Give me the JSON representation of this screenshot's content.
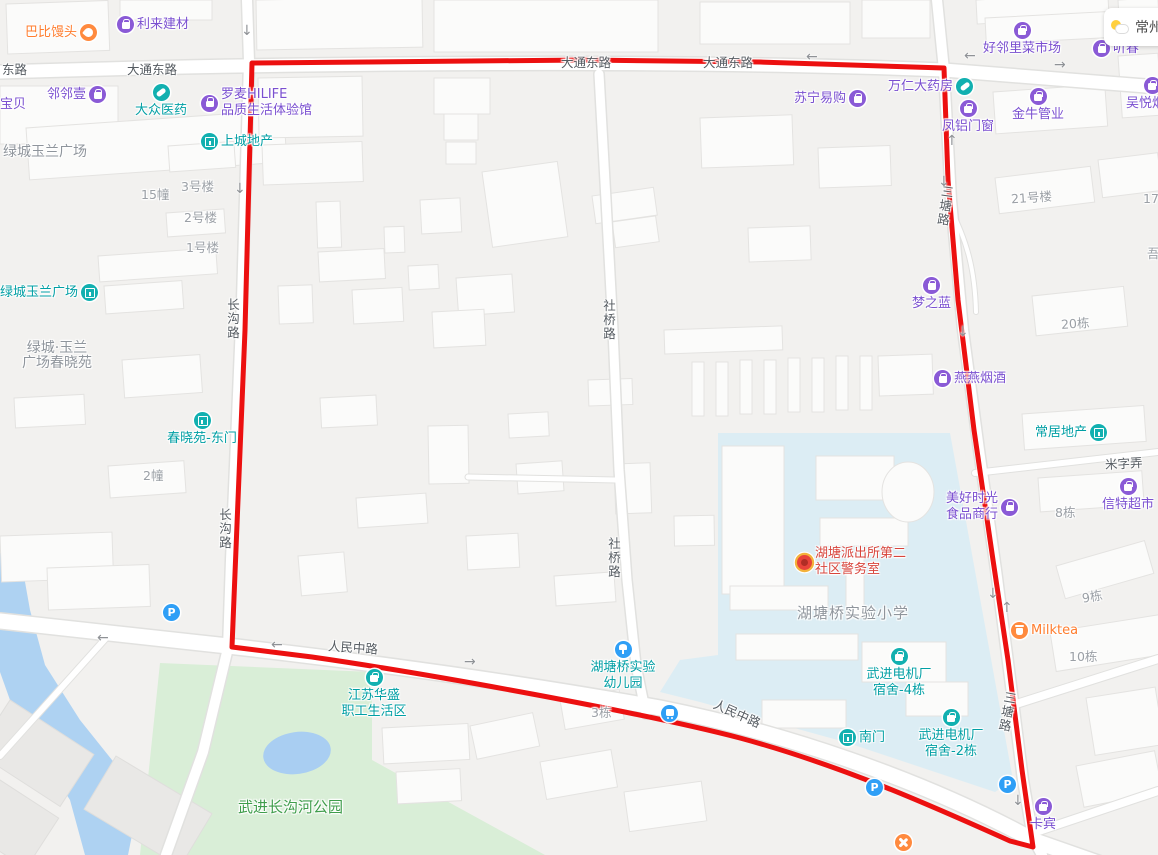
{
  "weather": {
    "city": "常州"
  },
  "colors": {
    "route_red": "#ec1010",
    "school_zone": "#dcedf4",
    "park_green": "#d9eed7",
    "water_blue": "#aed2f2",
    "poi_purple": "#7a4fd0",
    "poi_teal": "#009fa4",
    "poi_orange": "#ff7d2e",
    "poi_red": "#d8453c",
    "util_blue": "#2f9ff6"
  },
  "map": {
    "labels": [
      {
        "name": "road-donglu",
        "cls": "cls-road",
        "x": 2,
        "y": 62,
        "text": "东路"
      },
      {
        "name": "road-datongdonglu-1",
        "cls": "cls-road",
        "x": 127,
        "y": 62,
        "text": "大通东路"
      },
      {
        "name": "road-datongdonglu-2",
        "cls": "cls-road",
        "x": 561,
        "y": 55,
        "text": "大通东路"
      },
      {
        "name": "road-datongdonglu-3",
        "cls": "cls-road",
        "x": 703,
        "y": 55,
        "text": "大通东路"
      },
      {
        "name": "road-renminzhonglu-1",
        "cls": "cls-road",
        "x": 328,
        "y": 640,
        "rot": 4,
        "text": "人民中路"
      },
      {
        "name": "road-renminzhonglu-2",
        "cls": "cls-road",
        "x": 712,
        "y": 706,
        "rot": 24,
        "text": "人民中路"
      },
      {
        "name": "road-mizinong",
        "cls": "cls-road",
        "x": 1105,
        "y": 456,
        "rot": -3,
        "text": "米字弄"
      },
      {
        "name": "road-changgoulu-1",
        "cls": "cls-road",
        "x": 226,
        "y": 298,
        "vert": true,
        "text": "长沟路"
      },
      {
        "name": "road-changgoulu-2",
        "cls": "cls-road",
        "x": 218,
        "y": 508,
        "vert": true,
        "text": "长沟路"
      },
      {
        "name": "road-sheqiaolu-1",
        "cls": "cls-road",
        "x": 602,
        "y": 299,
        "vert": true,
        "text": "社桥路"
      },
      {
        "name": "road-sheqiaolu-2",
        "cls": "cls-road",
        "x": 607,
        "y": 537,
        "vert": true,
        "text": "社桥路"
      },
      {
        "name": "road-santanglu-1",
        "cls": "cls-road",
        "x": 938,
        "y": 185,
        "rot": 8,
        "vert": true,
        "text": "三塘路"
      },
      {
        "name": "road-santanglu-2",
        "cls": "cls-road",
        "x": 1000,
        "y": 691,
        "rot": 10,
        "vert": true,
        "text": "三塘路"
      },
      {
        "name": "area-lvcheng-plaza",
        "cls": "cls-area",
        "x": 3,
        "y": 145,
        "text": "绿城玉兰广场"
      },
      {
        "name": "area-chunxiaoyuan",
        "cls": "cls-area lines-c",
        "x": 22,
        "y": 341,
        "lines": [
          "绿城·玉兰",
          "广场春晓苑"
        ]
      },
      {
        "name": "area-hutangqiao-primary-school",
        "cls": "cls-area sz15",
        "x": 797,
        "y": 606,
        "text": "湖塘桥实验小学"
      },
      {
        "name": "area-changgouhe-park",
        "cls": "cls-green",
        "x": 238,
        "y": 800,
        "text": "武进长沟河公园"
      },
      {
        "name": "bldg-15",
        "cls": "cls-bldg",
        "x": 141,
        "y": 187,
        "text": "15幢"
      },
      {
        "name": "bldg-3hao",
        "cls": "cls-bldg",
        "x": 181,
        "y": 179,
        "text": "3号楼"
      },
      {
        "name": "bldg-2hao",
        "cls": "cls-bldg",
        "x": 184,
        "y": 210,
        "text": "2号楼"
      },
      {
        "name": "bldg-1hao",
        "cls": "cls-bldg",
        "x": 186,
        "y": 240,
        "text": "1号楼"
      },
      {
        "name": "bldg-2chuang",
        "cls": "cls-bldg",
        "x": 143,
        "y": 468,
        "text": "2幢"
      },
      {
        "name": "bldg-21hao",
        "cls": "cls-bldg",
        "x": 1011,
        "y": 190,
        "rot": -4,
        "text": "21号楼"
      },
      {
        "name": "bldg-17dong",
        "cls": "cls-bldg",
        "x": 1143,
        "y": 191,
        "text": "17栋"
      },
      {
        "name": "bldg-20dong",
        "cls": "cls-bldg",
        "x": 1061,
        "y": 316,
        "rot": -4,
        "text": "20栋"
      },
      {
        "name": "bldg-wu-partial",
        "cls": "cls-bldg",
        "x": 1147,
        "y": 246,
        "text": "吾"
      },
      {
        "name": "bldg-8dong",
        "cls": "cls-bldg",
        "x": 1055,
        "y": 505,
        "text": "8栋"
      },
      {
        "name": "bldg-9dong",
        "cls": "cls-bldg",
        "x": 1082,
        "y": 589,
        "rot": -10,
        "text": "9栋"
      },
      {
        "name": "bldg-10dong",
        "cls": "cls-bldg",
        "x": 1069,
        "y": 649,
        "text": "10栋"
      },
      {
        "name": "bldg-3dong",
        "cls": "cls-bldg",
        "x": 591,
        "y": 705,
        "text": "3栋"
      }
    ],
    "pois": [
      {
        "name": "poi-babi-mantou",
        "type": "orange",
        "icon": "hand",
        "layout": "ir",
        "x": 25,
        "y": 24,
        "text": "巴比馒头"
      },
      {
        "name": "poi-lilai-jiancai",
        "type": "purple",
        "icon": "bag",
        "layout": "il",
        "x": 117,
        "y": 16,
        "text": "利来建材"
      },
      {
        "name": "poi-linlinyi",
        "type": "purple",
        "icon": "bag",
        "layout": "ir",
        "x": 47,
        "y": 86,
        "text": "邻邻壹"
      },
      {
        "name": "poi-baobei",
        "type": "purple",
        "layout": "il",
        "x": 0,
        "y": 97,
        "text": "宝贝"
      },
      {
        "name": "poi-dazhong-yiyao",
        "type": "teal",
        "icon": "pill",
        "layout": "it",
        "x": 132,
        "y": 84,
        "w": 58,
        "text": "大众医药"
      },
      {
        "name": "poi-luomai-hilife",
        "type": "purple",
        "icon": "bag",
        "layout": "il",
        "x": 201,
        "y": 87,
        "lines": [
          "罗麦HILIFE",
          "品质生活体验馆"
        ]
      },
      {
        "name": "poi-shangcheng-dichan",
        "type": "teal",
        "icon": "gate",
        "layout": "il",
        "x": 201,
        "y": 133,
        "text": "上城地产"
      },
      {
        "name": "poi-suning",
        "type": "purple",
        "icon": "bag",
        "layout": "ir",
        "x": 794,
        "y": 90,
        "text": "苏宁易购"
      },
      {
        "name": "poi-wanren-dayaofang",
        "type": "purple",
        "icon": "pill",
        "ic": "teal",
        "layout": "ir",
        "x": 888,
        "y": 78,
        "text": "万仁大药房"
      },
      {
        "name": "poi-haolinli-caishichang",
        "type": "purple",
        "icon": "bag",
        "layout": "it",
        "x": 980,
        "y": 22,
        "w": 84,
        "text": "好邻里菜市场"
      },
      {
        "name": "poi-tingchun",
        "type": "purple",
        "icon": "bag",
        "layout": "il",
        "x": 1093,
        "y": 40,
        "text": "听春"
      },
      {
        "name": "poi-wuyue-yanjiu",
        "type": "purple",
        "icon": "bag",
        "layout": "it",
        "x": 1123,
        "y": 77,
        "w": 58,
        "text": "吴悦烟酒"
      },
      {
        "name": "poi-fenglv-menchuang",
        "type": "purple",
        "icon": "bag",
        "layout": "it",
        "x": 939,
        "y": 100,
        "w": 58,
        "text": "凤铝门窗"
      },
      {
        "name": "poi-jinniu-guanye",
        "type": "purple",
        "icon": "bag",
        "layout": "it",
        "x": 1009,
        "y": 88,
        "w": 58,
        "text": "金牛管业"
      },
      {
        "name": "poi-mengzhilan",
        "type": "purple",
        "icon": "bag",
        "layout": "it",
        "x": 909,
        "y": 277,
        "w": 45,
        "text": "梦之蓝"
      },
      {
        "name": "poi-yanyan-yanjiu",
        "type": "purple",
        "icon": "bag",
        "layout": "il",
        "x": 934,
        "y": 370,
        "text": "燕燕烟酒"
      },
      {
        "name": "poi-changju-dichan",
        "type": "teal",
        "icon": "gate",
        "layout": "ir",
        "x": 1035,
        "y": 424,
        "text": "常居地产"
      },
      {
        "name": "poi-meihao-shiguang",
        "type": "purple",
        "icon": "bag",
        "layout": "ir",
        "x": 946,
        "y": 491,
        "lines": [
          "美好时光",
          "食品商行"
        ]
      },
      {
        "name": "poi-xinte-chaoshi",
        "type": "purple",
        "icon": "bag",
        "layout": "it",
        "x": 1099,
        "y": 478,
        "w": 58,
        "text": "信特超市"
      },
      {
        "name": "poi-lvcheng-yulan-guangchang",
        "type": "teal",
        "icon": "gate",
        "layout": "ir",
        "x": 0,
        "y": 284,
        "text": "绿城玉兰广场"
      },
      {
        "name": "poi-chunxiaoyuan-dongmen",
        "type": "teal",
        "icon": "gate",
        "layout": "it",
        "x": 159,
        "y": 412,
        "w": 86,
        "text": "春晓苑-东门"
      },
      {
        "name": "poi-hutang-police-station",
        "type": "red",
        "icon": "badge",
        "layout": "il",
        "x": 797,
        "y": 546,
        "lines": [
          "湖塘派出所第二",
          "社区警务室"
        ]
      },
      {
        "name": "poi-milktea",
        "type": "orange",
        "icon": "cup",
        "layout": "il",
        "x": 1011,
        "y": 622,
        "text": "Milktea"
      },
      {
        "name": "poi-dianjichang-sushe-4",
        "type": "teal",
        "icon": "bag",
        "ic": "teal",
        "layout": "it",
        "x": 864,
        "y": 648,
        "w": 70,
        "lines": [
          "武进电机厂",
          "宿舍-4栋"
        ]
      },
      {
        "name": "poi-nanmen",
        "type": "teal",
        "icon": "gate",
        "layout": "il",
        "x": 839,
        "y": 729,
        "text": "南门"
      },
      {
        "name": "poi-dianjichang-sushe-2",
        "type": "teal",
        "icon": "bag",
        "ic": "teal",
        "layout": "it",
        "x": 916,
        "y": 709,
        "w": 70,
        "lines": [
          "武进电机厂",
          "宿舍-2栋"
        ]
      },
      {
        "name": "poi-kabin",
        "type": "purple",
        "icon": "bag",
        "layout": "it",
        "x": 1027,
        "y": 798,
        "w": 32,
        "text": "卡宾"
      },
      {
        "name": "poi-huasheng-shenghuoqu",
        "type": "teal",
        "icon": "bag",
        "ic": "teal",
        "layout": "it",
        "x": 339,
        "y": 669,
        "w": 70,
        "lines": [
          "江苏华盛",
          "职工生活区"
        ]
      },
      {
        "name": "poi-hutangqiao-kindergarten",
        "type": "teal",
        "icon": "tree",
        "ic": "blue",
        "layout": "it",
        "x": 588,
        "y": 641,
        "w": 70,
        "lines": [
          "湖塘桥实验",
          "幼儿园"
        ]
      },
      {
        "name": "parking-icon-1",
        "type": "blue",
        "icon": "p",
        "glyph": "P",
        "layout": "none",
        "x": 163,
        "y": 604
      },
      {
        "name": "parking-icon-2",
        "type": "blue",
        "icon": "p",
        "glyph": "P",
        "layout": "none",
        "x": 866,
        "y": 779
      },
      {
        "name": "parking-icon-3",
        "type": "blue",
        "icon": "p",
        "glyph": "P",
        "layout": "none",
        "x": 999,
        "y": 776
      },
      {
        "name": "bus-stop-icon",
        "type": "blue",
        "icon": "bus",
        "layout": "none",
        "x": 661,
        "y": 705
      },
      {
        "name": "restaurant-icon",
        "type": "orange",
        "icon": "fork",
        "layout": "none",
        "x": 895,
        "y": 834
      }
    ],
    "arrows": [
      {
        "x": 241,
        "y": 24,
        "g": "↓"
      },
      {
        "x": 234,
        "y": 182,
        "g": "↓"
      },
      {
        "x": 806,
        "y": 50,
        "g": "←"
      },
      {
        "x": 964,
        "y": 49,
        "g": "←"
      },
      {
        "x": 1054,
        "y": 58,
        "g": "→"
      },
      {
        "x": 938,
        "y": 175,
        "g": "↓"
      },
      {
        "x": 946,
        "y": 134,
        "g": "↑"
      },
      {
        "x": 957,
        "y": 325,
        "g": "↓"
      },
      {
        "x": 987,
        "y": 587,
        "g": "↓"
      },
      {
        "x": 1001,
        "y": 601,
        "g": "↑"
      },
      {
        "x": 1012,
        "y": 794,
        "g": "↓"
      },
      {
        "x": 97,
        "y": 631,
        "g": "←"
      },
      {
        "x": 271,
        "y": 638,
        "g": "←"
      },
      {
        "x": 464,
        "y": 655,
        "g": "→"
      }
    ]
  }
}
